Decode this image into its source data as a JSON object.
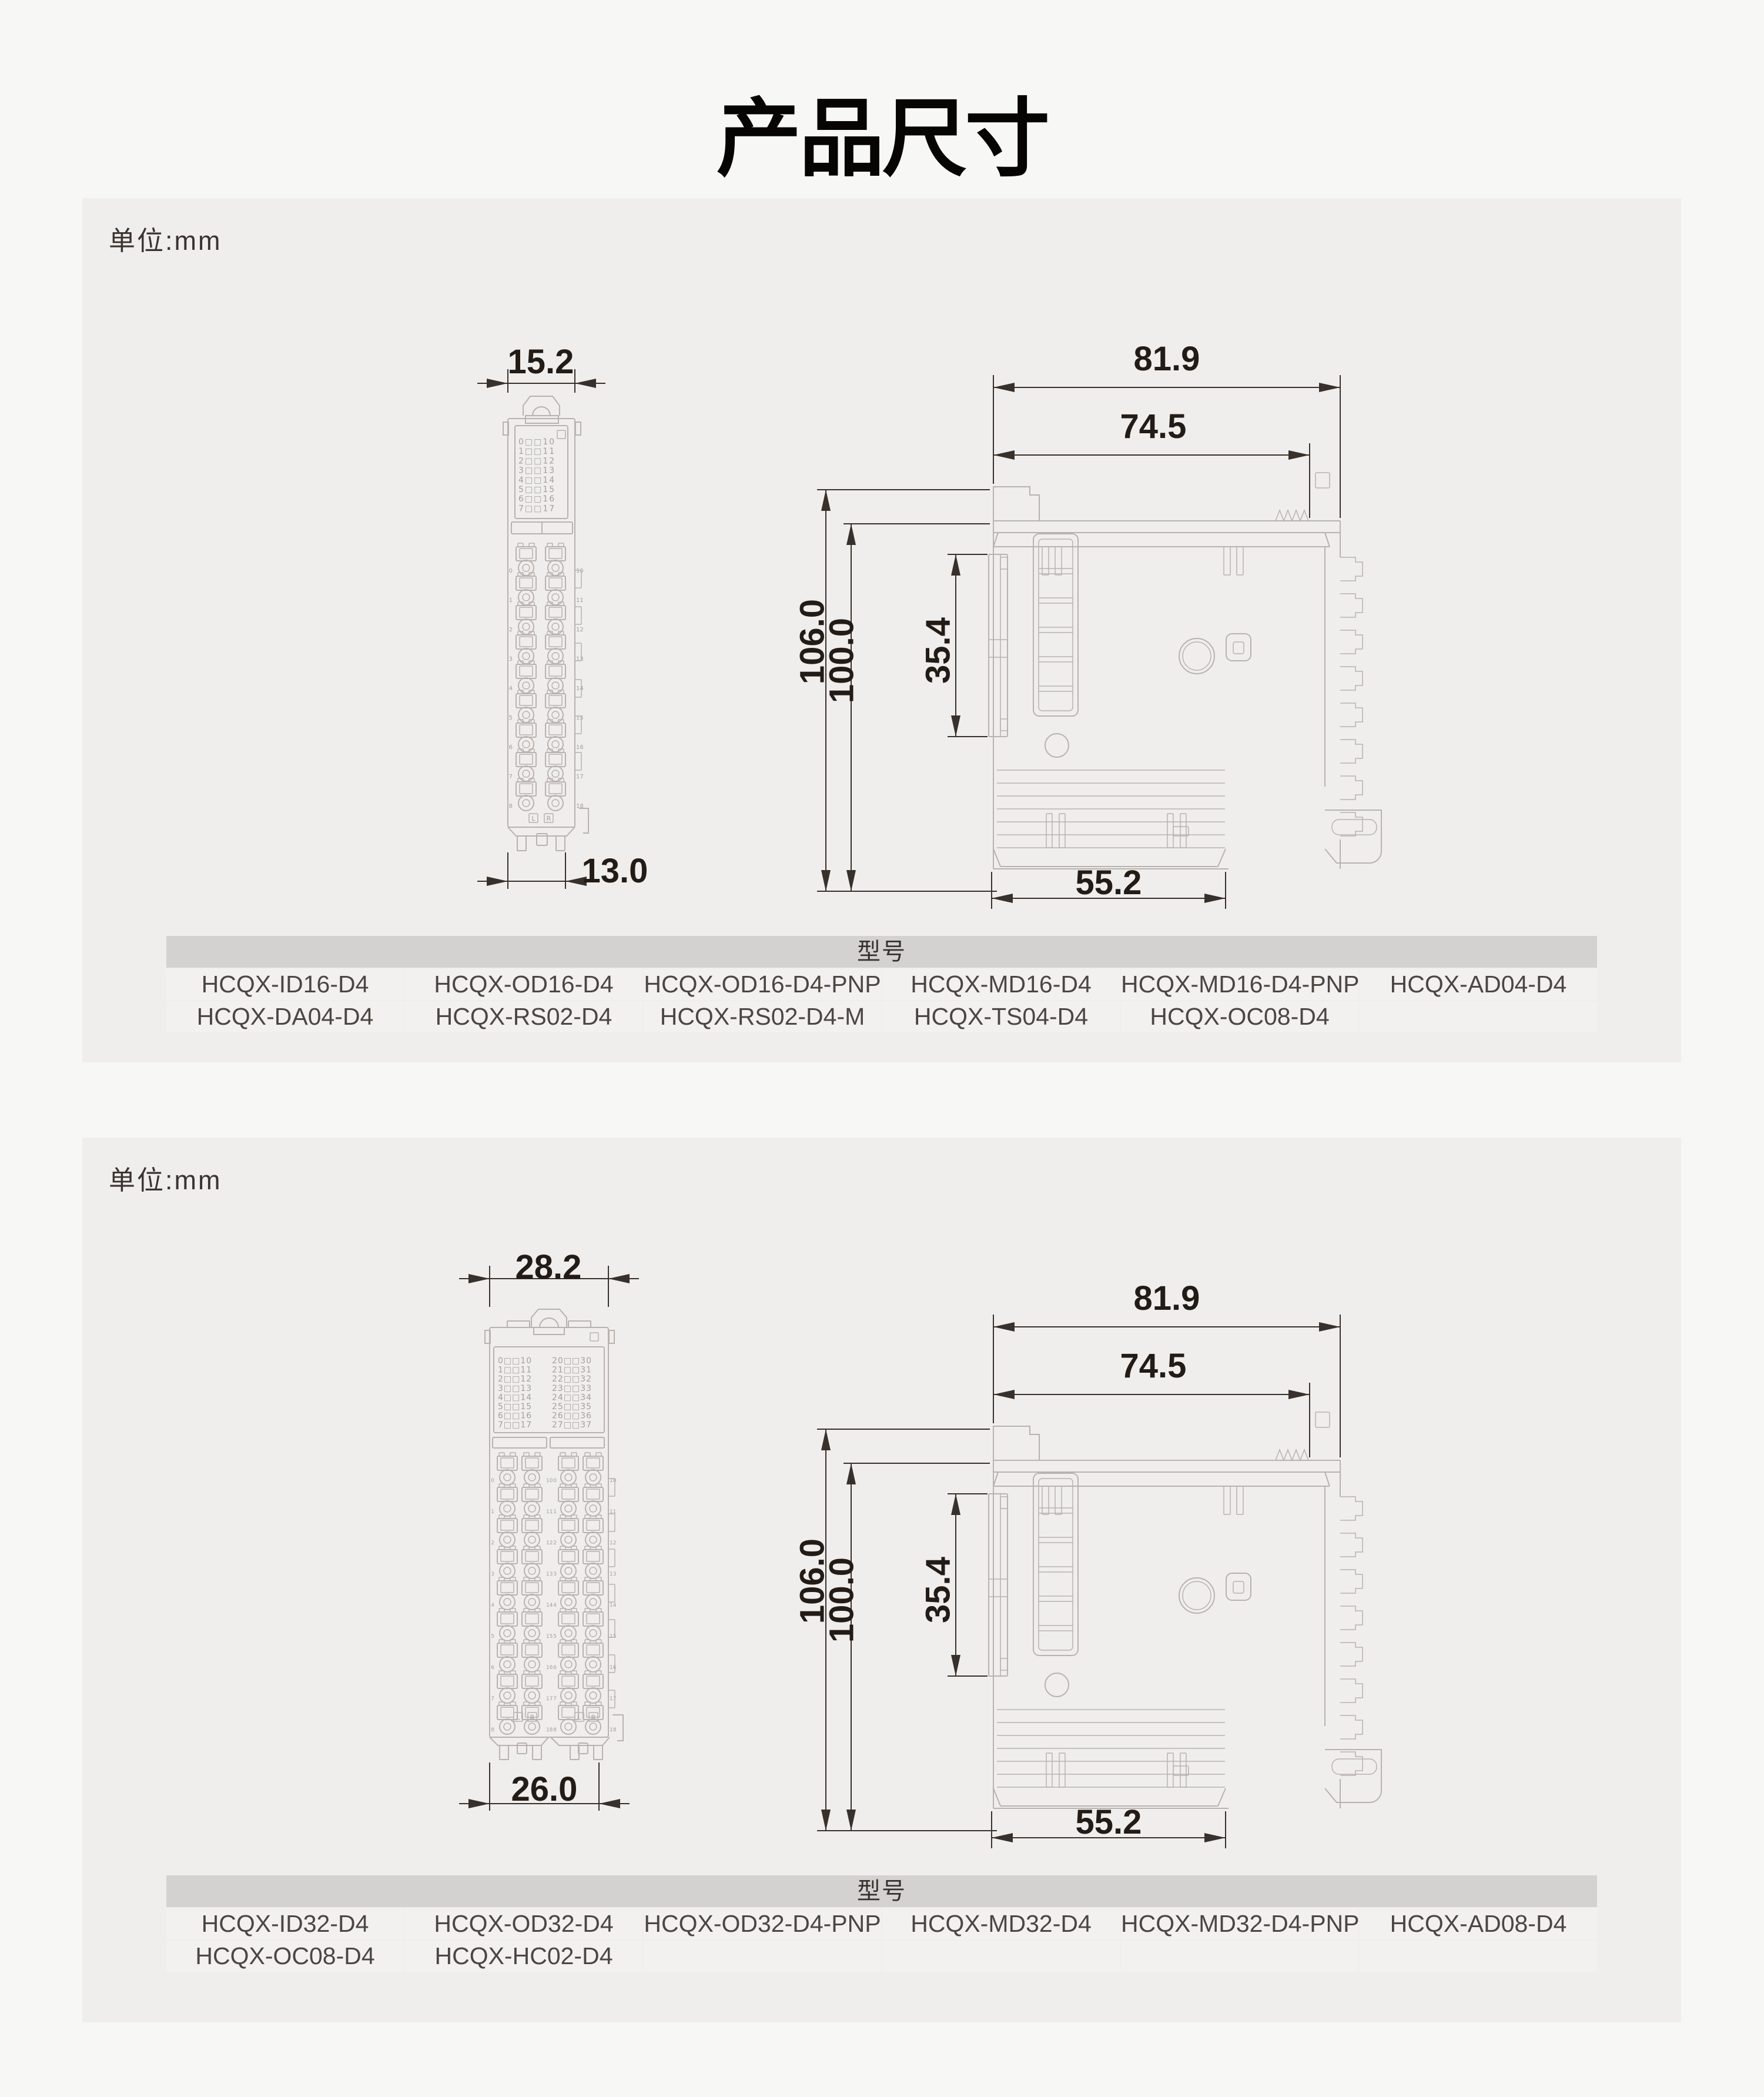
{
  "page": {
    "title": "产品尺寸"
  },
  "sections": [
    {
      "unit_label": "单位:mm",
      "front": {
        "dim_top": "15.2",
        "dim_bottom": "13.0",
        "led_groups": [
          [
            "0□□10",
            "1□□11",
            "2□□12",
            "3□□13",
            "4□□14",
            "5□□15",
            "6□□16",
            "7□□17"
          ]
        ],
        "term_left": [
          "0",
          "1",
          "2",
          "3",
          "4",
          "5",
          "6",
          "7",
          "8"
        ],
        "term_right": [
          "10",
          "11",
          "12",
          "13",
          "14",
          "15",
          "16",
          "17",
          "18"
        ],
        "corner_marks": [
          "L",
          "R"
        ]
      },
      "side": {
        "dim_w1": "81.9",
        "dim_w2": "74.5",
        "dim_h1": "106.0",
        "dim_h2": "100.0",
        "dim_clip": "35.4",
        "dim_bottom": "55.2"
      },
      "table": {
        "header": "型号",
        "rows": [
          [
            "HCQX-ID16-D4",
            "HCQX-OD16-D4",
            "HCQX-OD16-D4-PNP",
            "HCQX-MD16-D4",
            "HCQX-MD16-D4-PNP",
            "HCQX-AD04-D4"
          ],
          [
            "HCQX-DA04-D4",
            "HCQX-RS02-D4",
            "HCQX-RS02-D4-M",
            "HCQX-TS04-D4",
            "HCQX-OC08-D4",
            ""
          ]
        ]
      }
    },
    {
      "unit_label": "单位:mm",
      "front": {
        "dim_top": "28.2",
        "dim_bottom": "26.0",
        "led_groups": [
          [
            "0□□10",
            "1□□11",
            "2□□12",
            "3□□13",
            "4□□14",
            "5□□15",
            "6□□16",
            "7□□17"
          ],
          [
            "20□□30",
            "21□□31",
            "22□□32",
            "23□□33",
            "24□□34",
            "25□□35",
            "26□□36",
            "27□□37"
          ]
        ],
        "term_left": [
          "0",
          "1",
          "2",
          "3",
          "4",
          "5",
          "6",
          "7",
          "8"
        ],
        "term_right": [
          "10",
          "11",
          "12",
          "13",
          "14",
          "15",
          "16",
          "17",
          "18"
        ],
        "corner_marks": [
          "L",
          "R"
        ]
      },
      "side": {
        "dim_w1": "81.9",
        "dim_w2": "74.5",
        "dim_h1": "106.0",
        "dim_h2": "100.0",
        "dim_clip": "35.4",
        "dim_bottom": "55.2"
      },
      "table": {
        "header": "型号",
        "rows": [
          [
            "HCQX-ID32-D4",
            "HCQX-OD32-D4",
            "HCQX-OD32-D4-PNP",
            "HCQX-MD32-D4",
            "HCQX-MD32-D4-PNP",
            "HCQX-AD08-D4"
          ],
          [
            "HCQX-OC08-D4",
            "HCQX-HC02-D4",
            "",
            "",
            "",
            ""
          ]
        ]
      }
    }
  ]
}
